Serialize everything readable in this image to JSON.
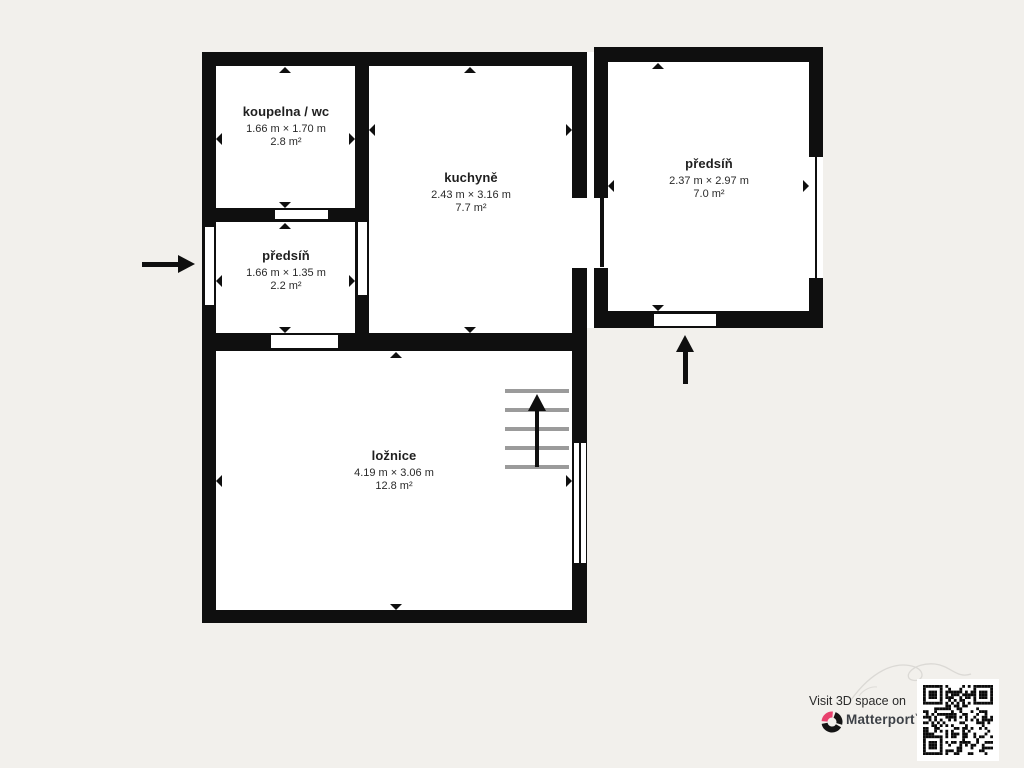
{
  "app": {
    "type": "floorplan-export"
  },
  "colors": {
    "background": "#f2f0ec",
    "wall": "#0f0f0f",
    "room_fill": "#ffffff",
    "stair_gray": "#9b9b9b",
    "brand_pink": "#e8416d",
    "brand_text": "#3d4147"
  },
  "rooms": [
    {
      "name": "koupelna / wc",
      "dimensions": "1.66 m × 1.70 m",
      "area": "2.8 m²"
    },
    {
      "name": "předsíň",
      "dimensions": "1.66 m × 1.35 m",
      "area": "2.2 m²"
    },
    {
      "name": "kuchyně",
      "dimensions": "2.43 m × 3.16 m",
      "area": "7.7 m²"
    },
    {
      "name": "ložnice",
      "dimensions": "4.19 m × 3.06 m",
      "area": "12.8 m²"
    },
    {
      "name": "předsíň",
      "dimensions": "2.37 m × 2.97 m",
      "area": "7.0 m²"
    }
  ],
  "footer": {
    "visit_text": "Visit 3D space on",
    "brand": "Matterport",
    "trademark": "™"
  },
  "icons": {
    "entrance_west": "arrow-right-icon",
    "entrance_south": "arrow-up-icon",
    "stairs": "stairs-up-arrow-icon",
    "qr": "qr-code",
    "logo": "matterport-logo"
  }
}
